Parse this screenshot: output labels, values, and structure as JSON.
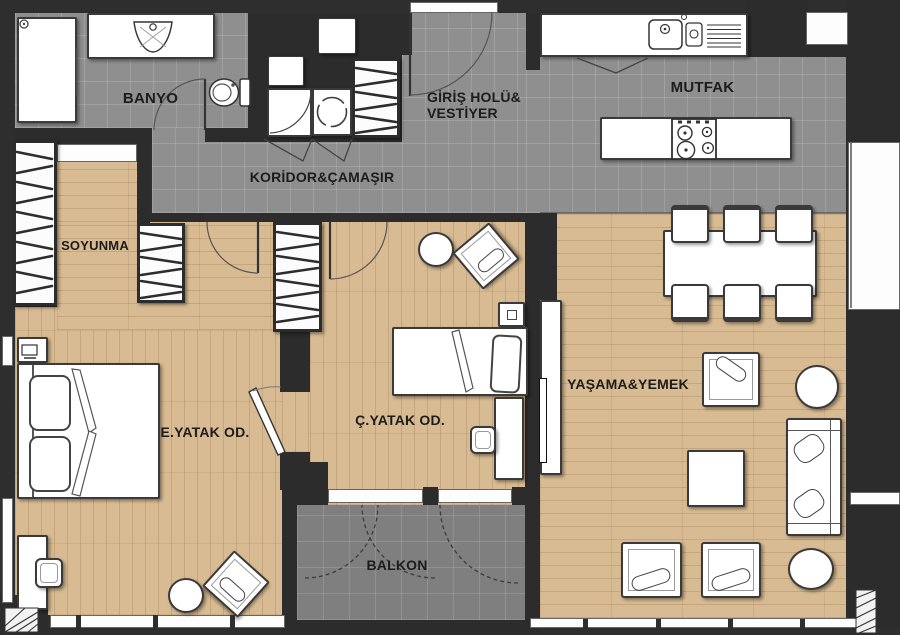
{
  "floorplan": {
    "rooms": {
      "banyo": {
        "label": "BANYO"
      },
      "giris": {
        "label_line1": "GİRİŞ HOLÜ&",
        "label_line2": "VESTİYER"
      },
      "mutfak": {
        "label": "MUTFAK"
      },
      "koridor": {
        "label": "KORİDOR&ÇAMAŞIR"
      },
      "soyunma": {
        "label": "SOYUNMA"
      },
      "e_yatak": {
        "label": "E.YATAK OD."
      },
      "c_yatak": {
        "label": "Ç.YATAK OD."
      },
      "yasama": {
        "label": "YAŞAMA&YEMEK"
      },
      "balkon": {
        "label": "BALKON"
      }
    },
    "fixtures": {
      "banyo": [
        "shower",
        "washbasin-counter",
        "toilet",
        "door"
      ],
      "giris": [
        "entry-door",
        "coat-wardrobe"
      ],
      "koridor": [
        "washing-machine",
        "laundry-cabinet",
        "bifold-doors"
      ],
      "mutfak": [
        "counter-with-sink",
        "island-with-cooktop",
        "tall-cabinet",
        "window"
      ],
      "soyunma": [
        "wardrobe-left",
        "wardrobe-right",
        "shelf"
      ],
      "e_yatak": [
        "double-bed",
        "nightstand",
        "desk",
        "desk-chair",
        "stool",
        "armchair",
        "door",
        "window"
      ],
      "c_yatak": [
        "single-bed",
        "nightstand",
        "desk",
        "desk-chair",
        "pouf",
        "armchair",
        "wardrobe",
        "door"
      ],
      "yasama": [
        "dining-table",
        "dining-chairs-6",
        "sofa",
        "armchair",
        "coffee-table",
        "round-side-table",
        "round-pouf",
        "tv-unit",
        "window"
      ],
      "balkon": [
        "folding-glass-doors",
        "column"
      ]
    },
    "colors": {
      "wall": "#2e2e2e",
      "tile": "#8f8f8f",
      "balcony_tile": "#7f7f7f",
      "wood": "#d8bb92",
      "furniture": "#ffffff",
      "line": "#333333",
      "label_text": "#1c1c1c"
    }
  }
}
